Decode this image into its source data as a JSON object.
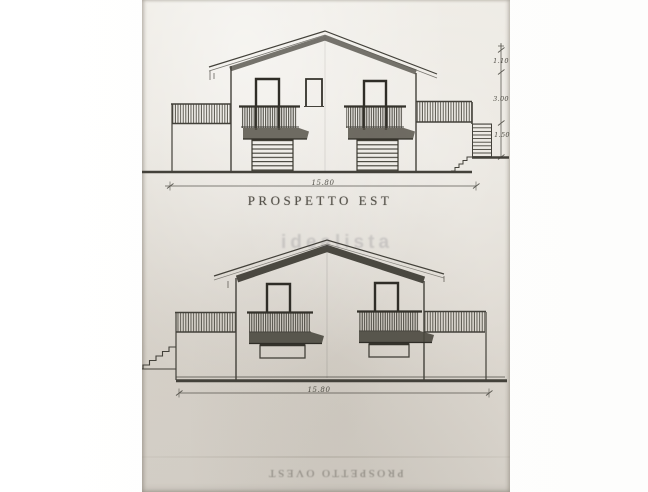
{
  "photo": {
    "background": "#ffffff",
    "paper_color": "#e3dfd7",
    "ink_color": "#43413a"
  },
  "drawings": {
    "top": {
      "name": "east-elevation",
      "title": "PROSPETTO EST",
      "width_dim": "15.80",
      "height_dims": [
        "1.10",
        "3.00",
        "1.50"
      ]
    },
    "bottom": {
      "name": "west-elevation",
      "width_dim": "15.80",
      "flipped_caption": "PROSPETTO OVEST"
    }
  },
  "watermark": {
    "text": "idealista"
  }
}
